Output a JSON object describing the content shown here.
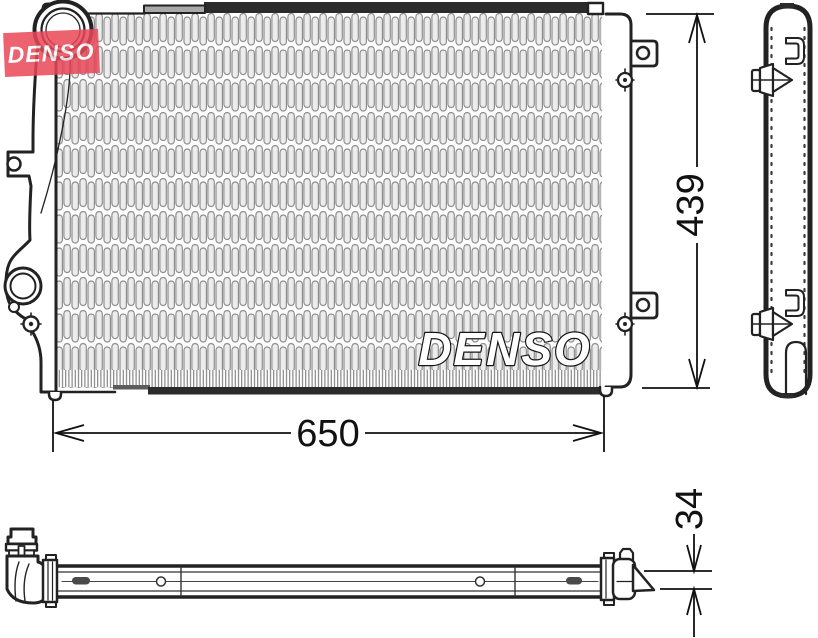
{
  "brand": {
    "watermark_text": "DENSO",
    "watermark_bg": "#e94757",
    "watermark_fg": "#ffffff",
    "core_logo_text": "DENSO"
  },
  "dimensions": {
    "width_mm": "650",
    "height_mm": "439",
    "depth_mm": "34"
  },
  "drawing": {
    "line_color": "#222222",
    "dark_bar_color": "#2b2b2b",
    "fin_line_color": "#8f8f8f"
  }
}
